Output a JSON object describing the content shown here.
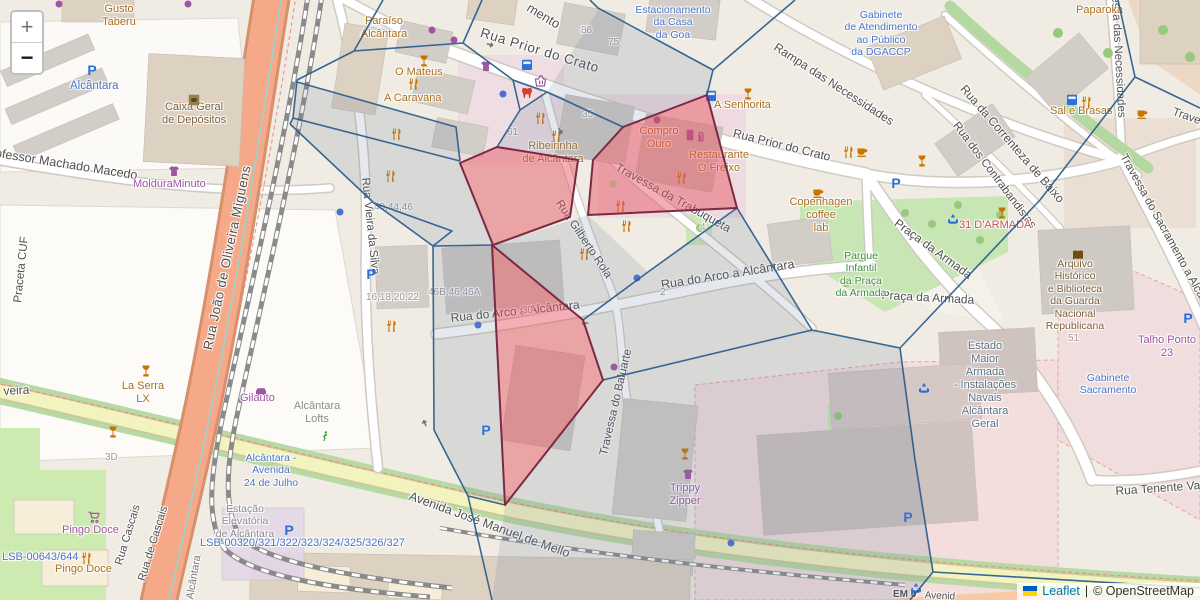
{
  "controls": {
    "zoom_in": "+",
    "zoom_out": "−"
  },
  "attribution": {
    "leaflet": "Leaflet",
    "separator": "|",
    "osm": "© OpenStreetMap",
    "flag_top_color": "#005BBB",
    "flag_bottom_color": "#FFD500"
  },
  "palette": {
    "street": "#4f4f4f",
    "amenity": "#a96e1e",
    "shop": "#9f55a3",
    "transit": "#4a74c9",
    "park": "#3e8e3e",
    "brown": "#7e5f3a",
    "military": "#5f7083",
    "red": "#d04f4f",
    "number": "#9b9b9b",
    "gray": "#8a8a8a",
    "rail": "#767676",
    "overlay_stroke": "#2e5f8f",
    "overlay_fill": "rgba(110,125,155,0.18)",
    "highlight_stroke": "#7a2a45",
    "highlight_fill": "rgba(229,77,90,0.45)",
    "icon_orange": "#c77400",
    "icon_purple": "#9f55a3",
    "icon_blue": "#2a6fdb",
    "icon_green": "#3aa13a",
    "icon_brown": "#734a08",
    "icon_red": "#d23f31"
  },
  "icon_text": {
    "parking": "P",
    "arrow": "➜"
  },
  "labels": [
    {
      "n": "street-rua-prior-do-crato-1",
      "t": "Rua Prior do Crato",
      "x": 483,
      "y": 25,
      "r": 17,
      "s": 13.5,
      "c": "street",
      "sp": 0.6
    },
    {
      "n": "street-rua-prior-do-crato-2",
      "t": "Rua Prior do Crato",
      "x": 735,
      "y": 126,
      "r": 14,
      "s": 12,
      "c": "street"
    },
    {
      "n": "street-rampa-das-necessidades",
      "t": "Rampa das Necessidades",
      "x": 779,
      "y": 40,
      "r": 33,
      "s": 12,
      "c": "street"
    },
    {
      "n": "street-rua-da-correnteza-de-baixo",
      "t": "Rua da Correnteza de Baixo",
      "x": 968,
      "y": 82,
      "r": 49,
      "s": 12,
      "c": "street"
    },
    {
      "n": "street-rua-dos-contrabandistas",
      "t": "Rua dos Contrabandistas",
      "x": 960,
      "y": 120,
      "r": 53,
      "s": 11.5,
      "c": "street"
    },
    {
      "n": "street-travessa-das-necessidades",
      "t": "essa das Necessidades",
      "x": 1121,
      "y": -4,
      "r": 87,
      "s": 11.5,
      "c": "street"
    },
    {
      "n": "street-travessa-do-sacramento",
      "t": "Travessa do Sacramento a Alcân",
      "x": 1128,
      "y": 152,
      "r": 61,
      "s": 11.5,
      "c": "street"
    },
    {
      "n": "street-travessa-partial",
      "t": "Trave",
      "x": 1175,
      "y": 106,
      "r": 20,
      "s": 11.5,
      "c": "street"
    },
    {
      "n": "street-travessa-da-trabuqueta",
      "t": "Travessa da Trabuqueta",
      "x": 620,
      "y": 160,
      "r": 29,
      "s": 12,
      "c": "street"
    },
    {
      "n": "street-rua-gilberto-rola",
      "t": "Rua Gilberto Rola",
      "x": 563,
      "y": 198,
      "r": 56,
      "s": 11.5,
      "c": "street"
    },
    {
      "n": "street-rua-vieira-da-silva",
      "t": "Rua Vieira da Silva",
      "x": 371,
      "y": 177,
      "r": 84,
      "s": 11.5,
      "c": "street"
    },
    {
      "n": "street-rua-do-arco-w",
      "t": "Rua do Arco a Alcântara",
      "x": 450,
      "y": 311,
      "r": -6,
      "s": 12,
      "c": "street"
    },
    {
      "n": "street-rua-do-arco-e",
      "t": "Rua do Arco a Alcântara",
      "x": 660,
      "y": 278,
      "r": -9,
      "s": 12.5,
      "c": "street"
    },
    {
      "n": "street-travessa-do-baluarte",
      "t": "Travessa do Baluarte",
      "x": 598,
      "y": 454,
      "r": -77,
      "s": 11.5,
      "c": "street"
    },
    {
      "n": "street-avenida-jose-manuel-de-mello",
      "t": "Avenida José Manuel de Mello",
      "x": 412,
      "y": 489,
      "r": 20,
      "s": 12.5,
      "c": "street"
    },
    {
      "n": "street-rua-tenente-valadim",
      "t": "Rua Tenente Valadim",
      "x": 1115,
      "y": 484,
      "r": -4,
      "s": 12,
      "c": "street"
    },
    {
      "n": "street-professor-machado-macedo",
      "t": "Professor Machado Macedo",
      "x": -16,
      "y": 144,
      "r": 9,
      "s": 12.5,
      "c": "street"
    },
    {
      "n": "street-praceta-cuf",
      "t": "Praceta CUF",
      "x": 12,
      "y": 302,
      "r": -84,
      "s": 11.5,
      "c": "street"
    },
    {
      "n": "street-rua-joao-de-oliveira-miguens",
      "t": "Rua João de Oliveira Miguens",
      "x": 200,
      "y": 348,
      "r": -78,
      "s": 13,
      "c": "street",
      "sp": 0.5
    },
    {
      "n": "street-rua-cascais",
      "t": "Rua Cascais",
      "x": 113,
      "y": 563,
      "r": -73,
      "s": 11,
      "c": "street"
    },
    {
      "n": "street-rua-de-cascais",
      "t": "Rua de Cascais",
      "x": 136,
      "y": 579,
      "r": -73,
      "s": 11,
      "c": "street"
    },
    {
      "n": "street-praca-da-armada-1",
      "t": "Praça da Armada",
      "x": 900,
      "y": 216,
      "r": 36,
      "s": 12,
      "c": "street"
    },
    {
      "n": "street-praca-da-armada-2",
      "t": "Praça da Armada",
      "x": 882,
      "y": 288,
      "r": 3,
      "s": 12,
      "c": "street"
    },
    {
      "n": "street-mento-partial",
      "t": "mento",
      "x": 532,
      "y": 0,
      "r": 31,
      "s": 13,
      "c": "street"
    },
    {
      "n": "street-veira-partial",
      "t": "veira",
      "x": 3,
      "y": 384,
      "r": -3,
      "s": 12,
      "c": "street"
    },
    {
      "n": "street-em6",
      "t": "EM 6",
      "x": 893,
      "y": 589,
      "s": 10,
      "c": "street",
      "b": 1
    },
    {
      "n": "street-avenid-partial",
      "t": "Avenid",
      "x": 925,
      "y": 590,
      "r": 3,
      "s": 10,
      "c": "street"
    },
    {
      "n": "poi-gusto-taberu",
      "t": "Gusto\nTaberu",
      "x": 97,
      "y": 3,
      "s": 11,
      "c": "amenity",
      "a": "c",
      "w": 44
    },
    {
      "n": "poi-paraiso-alcantara",
      "t": "Paraíso\nAlcântara",
      "x": 358,
      "y": 15,
      "s": 11,
      "c": "amenity",
      "a": "c",
      "w": 52
    },
    {
      "n": "poi-o-mateus",
      "t": "O Mateus",
      "x": 395,
      "y": 66,
      "s": 11,
      "c": "amenity"
    },
    {
      "n": "poi-a-caravana",
      "t": "A Caravana",
      "x": 384,
      "y": 92,
      "s": 11,
      "c": "amenity"
    },
    {
      "n": "poi-caixa-geral",
      "t": "Caixa Geral\nde Depósitos",
      "x": 162,
      "y": 101,
      "s": 11,
      "c": "brown",
      "a": "c",
      "w": 64
    },
    {
      "n": "poi-moldura-minuto",
      "t": "MolduraMinuto",
      "x": 133,
      "y": 178,
      "s": 11,
      "c": "shop"
    },
    {
      "n": "poi-alcantara-parking",
      "t": "Alcântara",
      "x": 70,
      "y": 80,
      "s": 11.5,
      "c": "transit"
    },
    {
      "n": "poi-ribeirinha",
      "t": "Ribeirinha\nde Alcântara",
      "x": 522,
      "y": 140,
      "s": 11,
      "c": "amenity",
      "a": "c",
      "w": 62
    },
    {
      "n": "poi-compro-ouro",
      "t": "Compro\nOuro",
      "x": 636,
      "y": 125,
      "s": 11,
      "c": "amenity",
      "a": "c",
      "w": 46
    },
    {
      "n": "poi-restaurante-o-freixo",
      "t": "Restaurante\nO Freixo",
      "x": 688,
      "y": 149,
      "s": 11,
      "c": "amenity",
      "a": "c",
      "w": 62
    },
    {
      "n": "poi-a-senhorita",
      "t": "A Senhorita",
      "x": 714,
      "y": 99,
      "s": 11,
      "c": "amenity"
    },
    {
      "n": "poi-copenhagen-coffee-lab",
      "t": "Copenhagen\ncoffee\nlab",
      "x": 789,
      "y": 196,
      "s": 11,
      "c": "amenity",
      "a": "c",
      "w": 64
    },
    {
      "n": "poi-parque-infantil",
      "t": "Parque\nInfantil\nda Praça\nda Armada",
      "x": 832,
      "y": 250,
      "s": 10.5,
      "c": "park",
      "a": "c",
      "w": 58
    },
    {
      "n": "poi-paparoka",
      "t": "Paparoka",
      "x": 1076,
      "y": 4,
      "s": 11,
      "c": "amenity"
    },
    {
      "n": "poi-sal-e-brasas",
      "t": "Sal e Brasas",
      "x": 1050,
      "y": 105,
      "s": 11,
      "c": "amenity"
    },
    {
      "n": "poi-31-darmada",
      "t": "31 D'ARMADA",
      "x": 959,
      "y": 219,
      "s": 11,
      "c": "red"
    },
    {
      "n": "poi-arquivo-gnr",
      "t": "Arquivo\nHistórico\ne Biblioteca\nda Guarda\nNacional\nRepublicana",
      "x": 1038,
      "y": 258,
      "s": 10.5,
      "c": "brown",
      "a": "c",
      "w": 74
    },
    {
      "n": "poi-estado-maior",
      "t": "Estado\nMaior\nArmada\n- Instalações\nNavais\nAlcântara\nGeral",
      "x": 945,
      "y": 340,
      "s": 11,
      "c": "military",
      "a": "c",
      "w": 80
    },
    {
      "n": "poi-gabinete-sacramento",
      "t": "Gabinete\nSacramento",
      "x": 1078,
      "y": 372,
      "s": 10.5,
      "c": "transit",
      "a": "c",
      "w": 60
    },
    {
      "n": "poi-talho-ponto-23",
      "t": "Talho Ponto\n23",
      "x": 1137,
      "y": 334,
      "s": 11,
      "c": "shop",
      "a": "c",
      "w": 60
    },
    {
      "n": "poi-gabinete-dgaccp",
      "t": "Gabinete\nde Atendimento\nao Público\nda DGACCP",
      "x": 838,
      "y": 9,
      "s": 10.5,
      "c": "transit",
      "a": "c",
      "w": 86
    },
    {
      "n": "poi-estacionamento-casa-goa",
      "t": "Estacionamento\nda Casa\nda Goa",
      "x": 632,
      "y": 4,
      "s": 10.5,
      "c": "transit",
      "a": "c",
      "w": 82
    },
    {
      "n": "poi-trippy-zipper",
      "t": "Trippy\nZipper",
      "x": 662,
      "y": 482,
      "s": 11,
      "c": "shop",
      "a": "c",
      "w": 46
    },
    {
      "n": "poi-la-serra-lx",
      "t": "La Serra\nLX",
      "x": 120,
      "y": 380,
      "s": 11,
      "c": "amenity",
      "a": "c",
      "w": 46
    },
    {
      "n": "poi-gilauto",
      "t": "Gilauto",
      "x": 240,
      "y": 392,
      "s": 11,
      "c": "shop"
    },
    {
      "n": "poi-alcantara-lofts",
      "t": "Alcântara\nLofts",
      "x": 290,
      "y": 400,
      "s": 11,
      "c": "gray",
      "a": "c",
      "w": 54
    },
    {
      "n": "poi-alcantara-avenida-24-julho",
      "t": "Alcântara -\nAvenida\n24 de Julho",
      "x": 239,
      "y": 452,
      "s": 10.5,
      "c": "transit",
      "a": "c",
      "w": 64
    },
    {
      "n": "poi-estacao-elevatoria",
      "t": "Estação\nElevatória\nde Alcântara",
      "x": 211,
      "y": 503,
      "s": 10.5,
      "c": "gray",
      "a": "c",
      "w": 68
    },
    {
      "n": "poi-lsb-00320",
      "t": "LSB-00320/321/322/323/324/325/326/327",
      "x": 200,
      "y": 537,
      "s": 11,
      "c": "transit"
    },
    {
      "n": "poi-lsb-00643",
      "t": "LSB-00643/644",
      "x": 2,
      "y": 551,
      "s": 11,
      "c": "transit"
    },
    {
      "n": "poi-pingo-doce-1",
      "t": "Pingo Doce",
      "x": 62,
      "y": 524,
      "s": 11,
      "c": "shop"
    },
    {
      "n": "poi-pingo-doce-2",
      "t": "Pingo Doce",
      "x": 55,
      "y": 563,
      "s": 11,
      "c": "amenity"
    },
    {
      "n": "rail-alcantara",
      "t": "Alcântara",
      "x": 184,
      "y": 598,
      "r": -80,
      "s": 10.5,
      "c": "rail"
    },
    {
      "n": "num-3d",
      "t": "3D",
      "x": 105,
      "y": 452,
      "s": 10,
      "c": "number"
    },
    {
      "n": "num-86",
      "t": "86",
      "x": 581,
      "y": 25,
      "s": 10,
      "c": "number"
    },
    {
      "n": "num-75",
      "t": "75",
      "x": 608,
      "y": 37,
      "s": 10,
      "c": "number"
    },
    {
      "n": "num-35",
      "t": "35",
      "x": 582,
      "y": 109,
      "s": 10,
      "c": "number"
    },
    {
      "n": "num-61",
      "t": "61",
      "x": 507,
      "y": 127,
      "s": 10,
      "c": "number"
    },
    {
      "n": "num-40-44-46",
      "t": "40,44,46",
      "x": 374,
      "y": 202,
      "s": 10,
      "c": "number"
    },
    {
      "n": "num-16-18-20-22",
      "t": "16,18,20,22",
      "x": 366,
      "y": 292,
      "s": 10,
      "c": "number"
    },
    {
      "n": "num-46b-46-46a",
      "t": "46B,46,46A",
      "x": 428,
      "y": 287,
      "s": 10,
      "c": "number"
    },
    {
      "n": "num-30",
      "t": "30",
      "x": 522,
      "y": 305,
      "s": 10,
      "c": "number"
    },
    {
      "n": "num-2",
      "t": "2",
      "x": 660,
      "y": 287,
      "s": 10,
      "c": "number"
    },
    {
      "n": "num-4",
      "t": "4",
      "x": 700,
      "y": 222,
      "s": 10,
      "c": "number"
    },
    {
      "n": "num-51",
      "t": "51",
      "x": 1068,
      "y": 333,
      "s": 10,
      "c": "number"
    }
  ],
  "icons": [
    {
      "k": "parking",
      "x": 92,
      "y": 70
    },
    {
      "k": "parking",
      "x": 896,
      "y": 183
    },
    {
      "k": "parking",
      "x": 486,
      "y": 430
    },
    {
      "k": "parking",
      "x": 371,
      "y": 274
    },
    {
      "k": "parking",
      "x": 908,
      "y": 517
    },
    {
      "k": "parking",
      "x": 1188,
      "y": 318
    },
    {
      "k": "parking",
      "x": 289,
      "y": 530
    },
    {
      "k": "bus",
      "x": 705,
      "y": 90
    },
    {
      "k": "bus",
      "x": 521,
      "y": 59
    },
    {
      "k": "bus",
      "x": 1066,
      "y": 94
    },
    {
      "k": "fountain",
      "x": 947,
      "y": 213
    },
    {
      "k": "fountain",
      "x": 918,
      "y": 382
    },
    {
      "k": "fountain",
      "x": 910,
      "y": 582
    },
    {
      "k": "cutlery",
      "x": 534,
      "y": 112
    },
    {
      "k": "cutlery",
      "x": 550,
      "y": 130
    },
    {
      "k": "cutlery",
      "x": 675,
      "y": 172
    },
    {
      "k": "cutlery",
      "x": 614,
      "y": 200
    },
    {
      "k": "cutlery",
      "x": 620,
      "y": 220
    },
    {
      "k": "cutlery",
      "x": 407,
      "y": 78
    },
    {
      "k": "cutlery",
      "x": 390,
      "y": 128
    },
    {
      "k": "cutlery",
      "x": 384,
      "y": 170
    },
    {
      "k": "cutlery",
      "x": 385,
      "y": 320
    },
    {
      "k": "cutlery",
      "x": 578,
      "y": 248
    },
    {
      "k": "cutlery",
      "x": 842,
      "y": 146
    },
    {
      "k": "cutlery",
      "x": 1080,
      "y": 96
    },
    {
      "k": "cutlery",
      "x": 80,
      "y": 552
    },
    {
      "k": "glass",
      "x": 418,
      "y": 55
    },
    {
      "k": "glass",
      "x": 742,
      "y": 88
    },
    {
      "k": "glass",
      "x": 916,
      "y": 155
    },
    {
      "k": "glass",
      "x": 996,
      "y": 207
    },
    {
      "k": "glass",
      "x": 679,
      "y": 448
    },
    {
      "k": "glass",
      "x": 140,
      "y": 365
    },
    {
      "k": "glass",
      "x": 107,
      "y": 426
    },
    {
      "k": "cup",
      "x": 1136,
      "y": 108
    },
    {
      "k": "cup",
      "x": 812,
      "y": 187
    },
    {
      "k": "cup",
      "x": 856,
      "y": 146
    },
    {
      "k": "shirt",
      "x": 480,
      "y": 60
    },
    {
      "k": "shirt",
      "x": 682,
      "y": 468
    },
    {
      "k": "shirt",
      "x": 168,
      "y": 165
    },
    {
      "k": "cart",
      "x": 88,
      "y": 511
    },
    {
      "k": "car",
      "x": 255,
      "y": 384
    },
    {
      "k": "basket",
      "x": 535,
      "y": 75
    },
    {
      "k": "phone",
      "x": 684,
      "y": 129
    },
    {
      "k": "clip",
      "x": 695,
      "y": 131
    },
    {
      "k": "tooth",
      "x": 521,
      "y": 87
    },
    {
      "k": "book",
      "x": 1072,
      "y": 249
    },
    {
      "k": "bank",
      "x": 188,
      "y": 94
    },
    {
      "k": "runner",
      "x": 319,
      "y": 430
    },
    {
      "k": "dot",
      "x": 503,
      "y": 94,
      "c": "#4a6fd8"
    },
    {
      "k": "dot",
      "x": 340,
      "y": 212,
      "c": "#4a6fd8"
    },
    {
      "k": "dot",
      "x": 478,
      "y": 325,
      "c": "#4a6fd8"
    },
    {
      "k": "dot",
      "x": 637,
      "y": 278,
      "c": "#4a6fd8"
    },
    {
      "k": "dot",
      "x": 731,
      "y": 543,
      "c": "#4a6fd8"
    },
    {
      "k": "dot",
      "x": 614,
      "y": 367,
      "c": "#9f55a3"
    },
    {
      "k": "dot",
      "x": 657,
      "y": 120,
      "c": "#9f55a3"
    },
    {
      "k": "dot",
      "x": 432,
      "y": 30,
      "c": "#9f55a3"
    },
    {
      "k": "dot",
      "x": 454,
      "y": 40,
      "c": "#9f55a3"
    },
    {
      "k": "dot",
      "x": 59,
      "y": 4,
      "c": "#9f55a3"
    },
    {
      "k": "dot",
      "x": 188,
      "y": 4,
      "c": "#9f55a3"
    },
    {
      "k": "arrow",
      "x": 490,
      "y": 45,
      "r": 17
    },
    {
      "k": "arrow",
      "x": 585,
      "y": 323,
      "r": 174
    },
    {
      "k": "arrow",
      "x": 560,
      "y": 131,
      "r": 62
    },
    {
      "k": "arrow",
      "x": 425,
      "y": 423,
      "r": -115
    }
  ]
}
